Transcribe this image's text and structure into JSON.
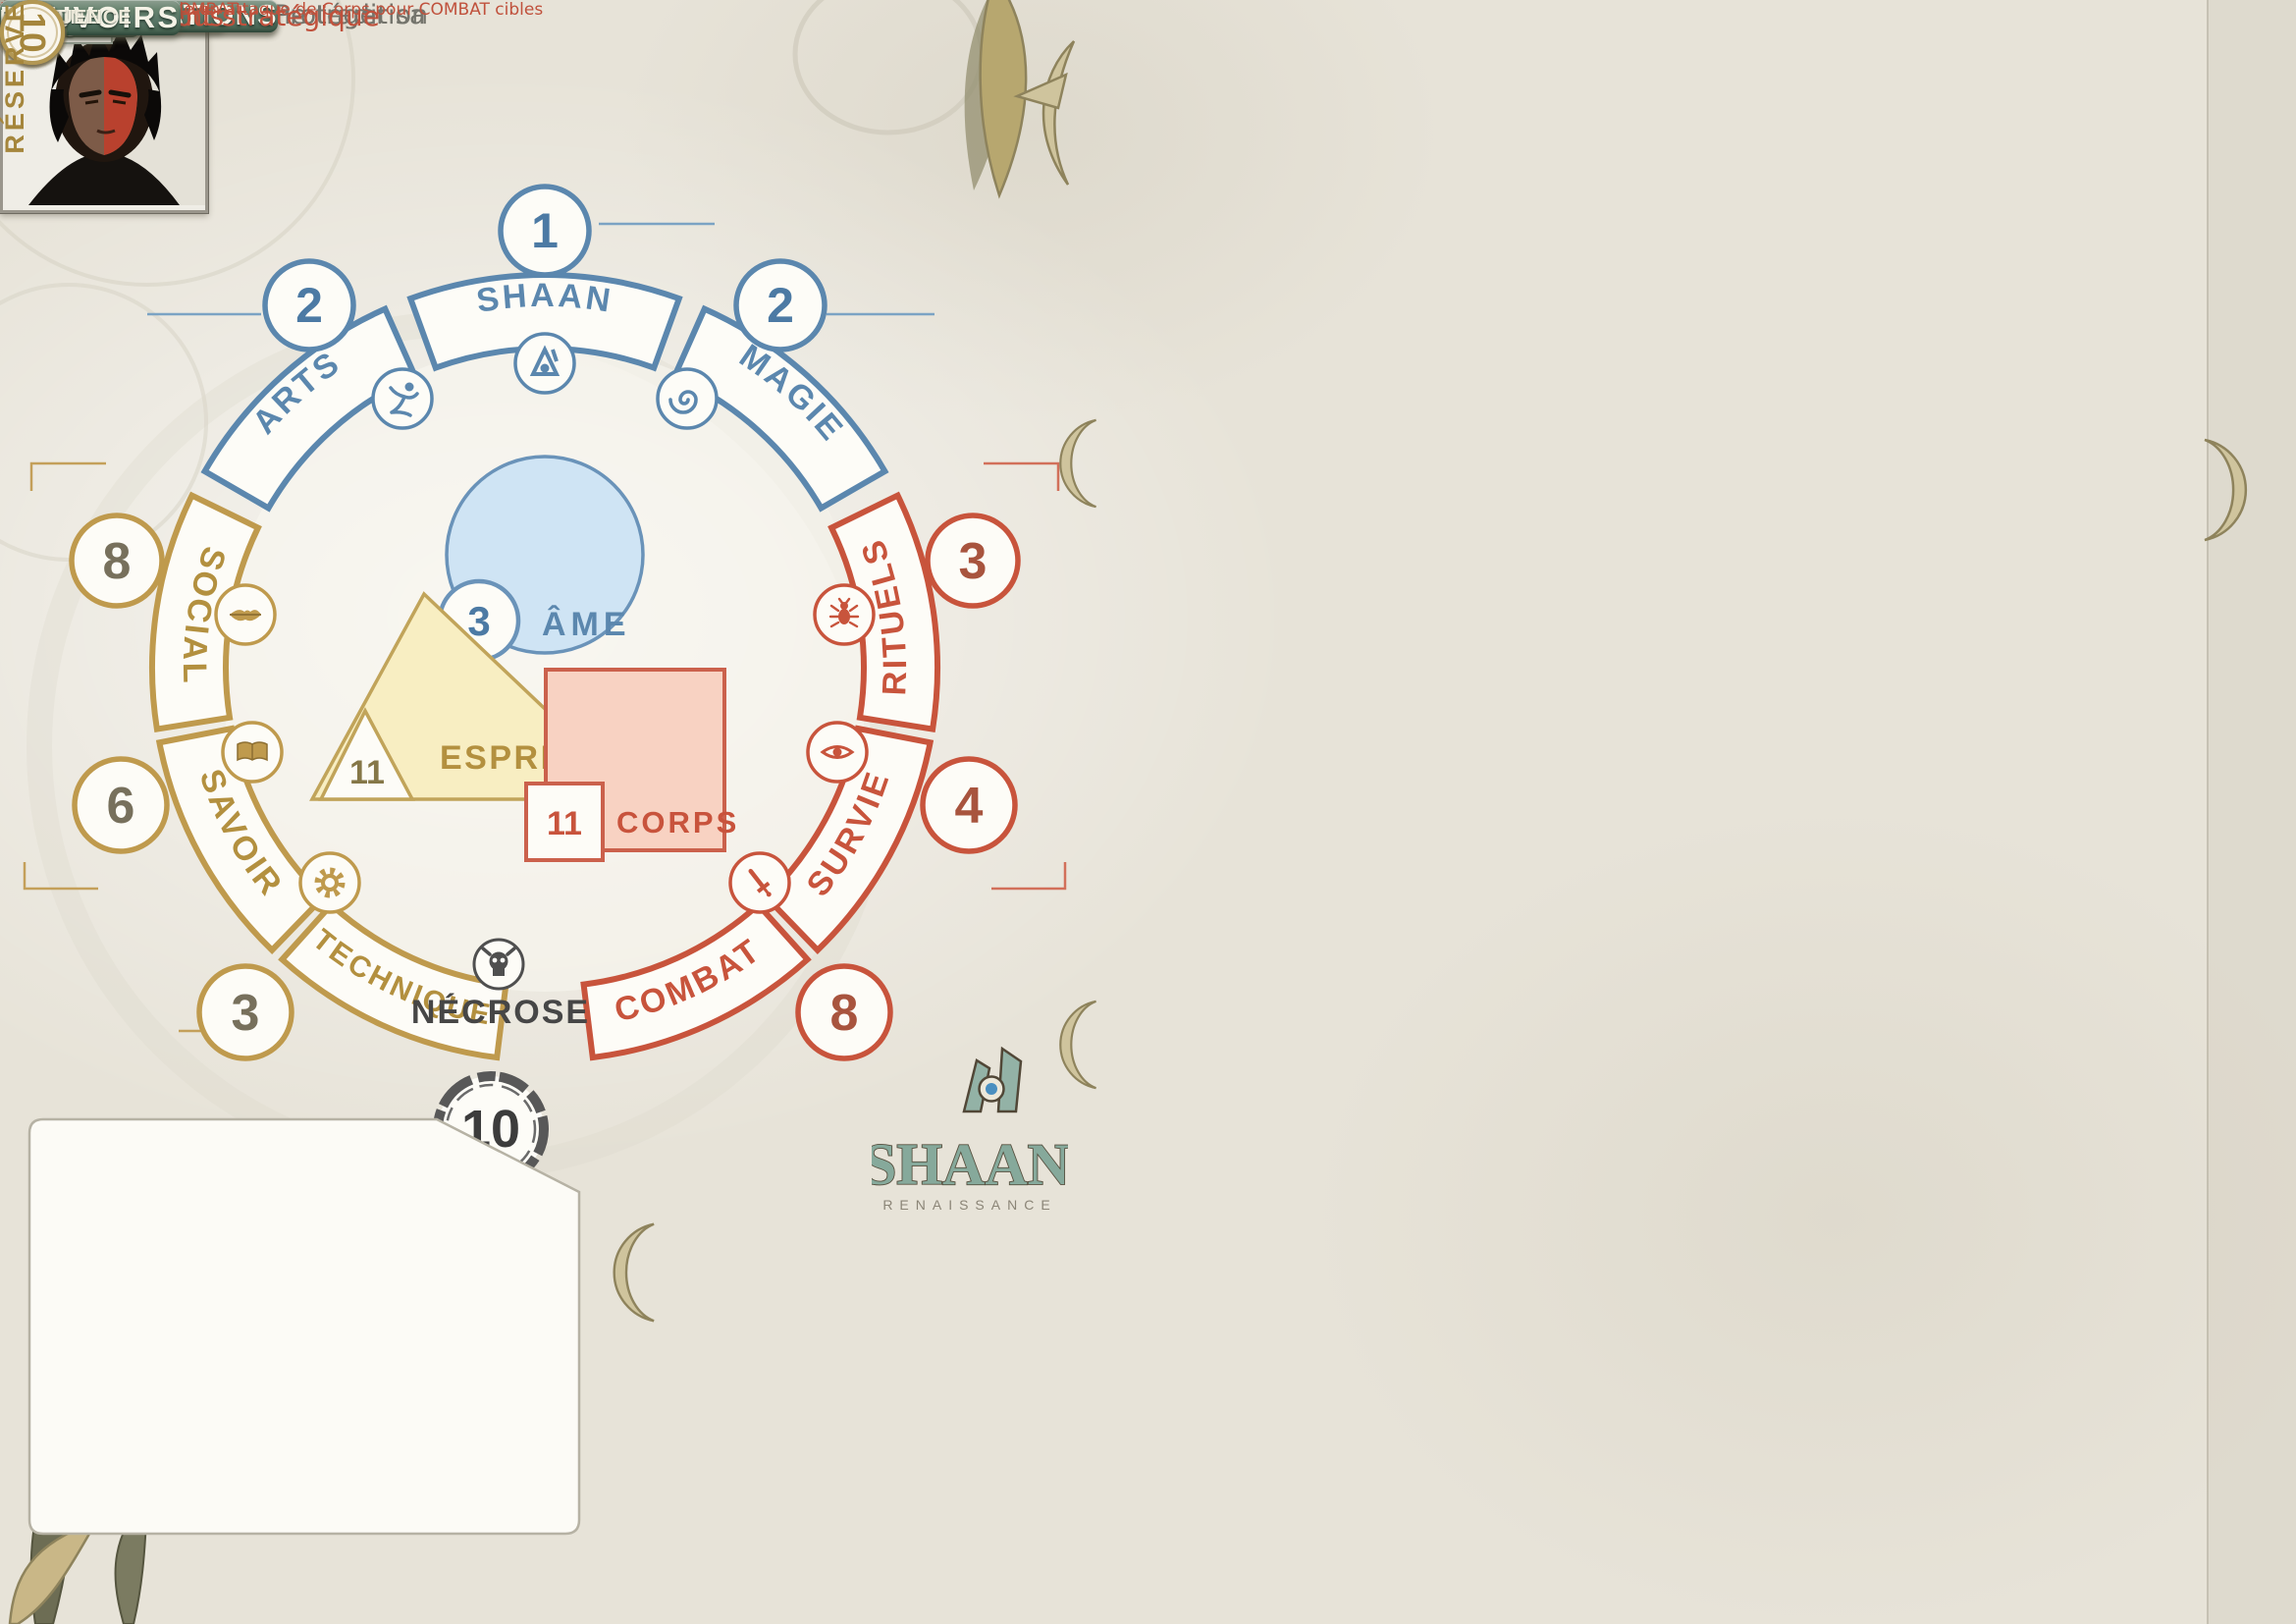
{
  "header": {
    "nom_label": "NOM :",
    "nom_value": "SERGIO MANDELLA",
    "race_label": "RACE :",
    "race_value": "Humain",
    "peuple_label": "PEUPLE :",
    "peuple_value": "Cités",
    "caste_label": "CASTE :",
    "caste_value": "Négociant"
  },
  "wheel": {
    "shaan": {
      "label": "SHAAN",
      "value": "1"
    },
    "arts": {
      "label": "ARTS",
      "value": "2"
    },
    "magie": {
      "label": "MAGIE",
      "value": "2"
    },
    "social": {
      "label": "SOCIAL",
      "value": "8"
    },
    "savoir": {
      "label": "SAVOIR",
      "value": "6"
    },
    "technique": {
      "label": "TECHNIQUE",
      "value": "3"
    },
    "rituels": {
      "label": "RITUELS",
      "value": "3"
    },
    "survie": {
      "label": "SURVIE",
      "value": "4"
    },
    "combat": {
      "label": "COMBAT",
      "value": "8"
    },
    "ame": {
      "label": "ÂME",
      "value": "3"
    },
    "esprit": {
      "label": "ESPRIT",
      "value": "11"
    },
    "corps": {
      "label": "CORPS",
      "value": "11"
    },
    "necrose": {
      "label": "NÉCROSE",
      "value": "10"
    }
  },
  "identity": {
    "sexe_label": "SEXE :",
    "sexe_value": "♂",
    "age_label": "ÂGE :",
    "taille_label": "TAILLE :",
    "poids_label": "POIDS :",
    "metier_label": "MÉTIER :",
    "metier_value": "Politicien",
    "element_primaire_label": "ÉLÉMENT PRIMAIRE :",
    "element_secondaire_label": "ÉLÉMENT SECONDAIRE :",
    "temperament_label": "TEMPÉRAMENT :",
    "nom_du_shaani_label": "NOM DU SHAANI :",
    "motivations_label": "MOTIVATIONS :",
    "motivations_value_line1": "Remplir un contrat - Protéger sa",
    "motivations_value_line2": "famille - Respecter une tradition"
  },
  "experience": {
    "label": "EXPÉRIENCE",
    "slash": "/",
    "value": "128"
  },
  "prestige": {
    "label": "PRESTIGE",
    "value": ""
  },
  "logo": {
    "title": "SHAAN",
    "subtitle": "RENAISSANCE"
  },
  "protections": {
    "title": "PROTECTIONS",
    "columns": [
      "CORPS",
      "ÂME",
      "ESPRIT"
    ]
  },
  "acquis": {
    "title": "ACQUIS"
  },
  "credos": {
    "label": "CREDOS",
    "value": "0"
  },
  "specialisations": {
    "title": "SPÉCIALISATIONS",
    "domaine_label": "DOMAINE",
    "bonus_label": "BONUS",
    "acquis_label": "ACQUIS"
  },
  "pouvoirs": {
    "title": "POUVOIRS",
    "domaine_label": "DOMAINE",
    "frequence_label": "FRÉQUENCE",
    "effet_label": "EFFET",
    "rows": [
      {
        "name": "Seul contre tous",
        "domaine": "COMBAT",
        "frequence": "perm",
        "effet": "coopération impossible en attaque de Corps pour COMBAT cibles"
      },
      {
        "name": "Positionnement stratégique",
        "domaine": "COMBAT",
        "frequence": "perm",
        "effet": "initiative = 1D10 + COMBAT"
      }
    ]
  },
  "reserve": {
    "label": "RÉSERVE",
    "slots": [
      "1",
      "2",
      "3",
      "4",
      "5",
      "6",
      "7",
      "8",
      "9",
      "10"
    ]
  }
}
